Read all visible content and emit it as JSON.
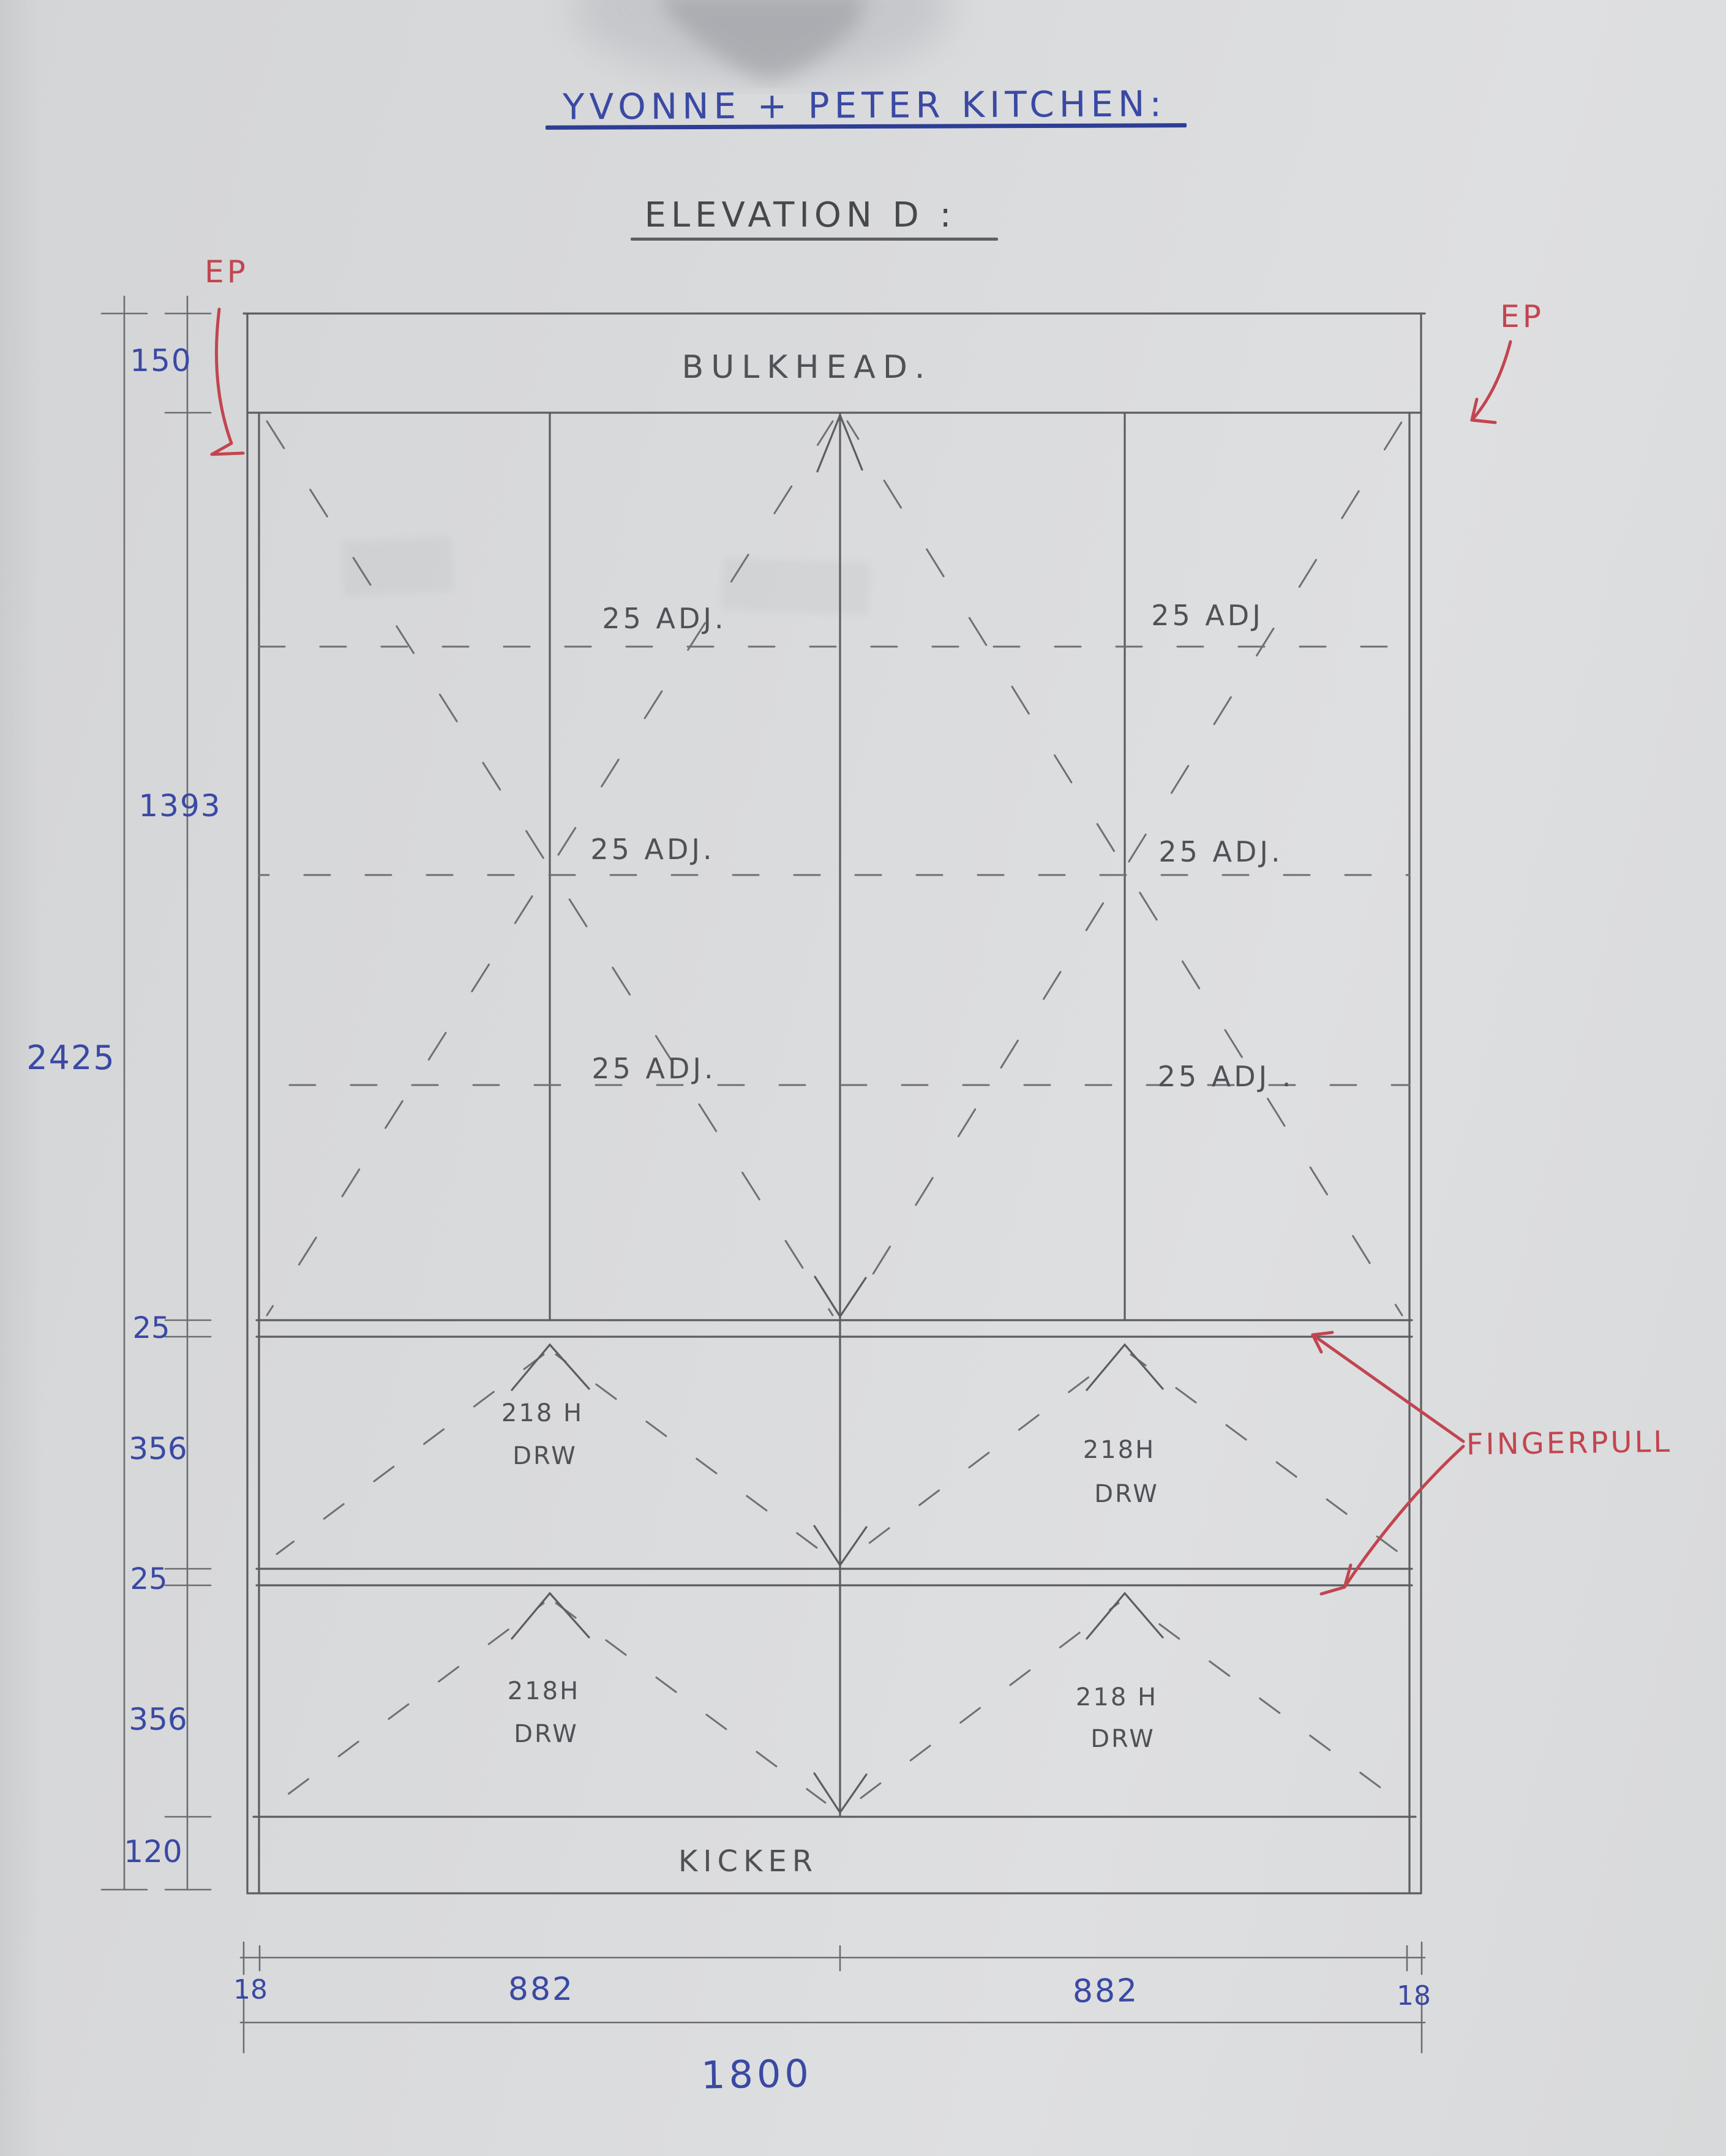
{
  "title": "YVONNE + PETER KITCHEN:",
  "subtitle": "ELEVATION D :",
  "drawing": {
    "bulkhead": "BULKHEAD.",
    "kicker": "KICKER",
    "shelves": {
      "row1_left": "25 ADJ.",
      "row1_right": "25 ADJ",
      "row2_left": "25 ADJ.",
      "row2_right": "25 ADJ.",
      "row3_left": "25 ADJ.",
      "row3_right": "25 ADJ ."
    },
    "drawers": {
      "d1_left_line1": "218 H",
      "d1_left_line2": "DRW",
      "d1_right_line1": "218H",
      "d1_right_line2": "DRW",
      "d2_left_line1": "218H",
      "d2_left_line2": "DRW",
      "d2_right_line1": "218 H",
      "d2_right_line2": "DRW"
    }
  },
  "annotations": {
    "ep_left": "EP",
    "ep_right": "EP",
    "fingerpull": "FINGERPULL"
  },
  "dims": {
    "left": {
      "bulkhead": "150",
      "doors": "1393",
      "total": "2425",
      "rail_top": "25",
      "drawer1": "356",
      "rail_mid": "25",
      "drawer2": "356",
      "kicker": "120"
    },
    "bottom": {
      "end_left": "18",
      "bay_left": "882",
      "bay_right": "882",
      "end_right": "18",
      "overall": "1800"
    }
  },
  "colors": {
    "ink_blue": "#3a49a3",
    "ink_red": "#c2454f",
    "pencil": "#5b5d61",
    "paper": "#d8d9db"
  }
}
